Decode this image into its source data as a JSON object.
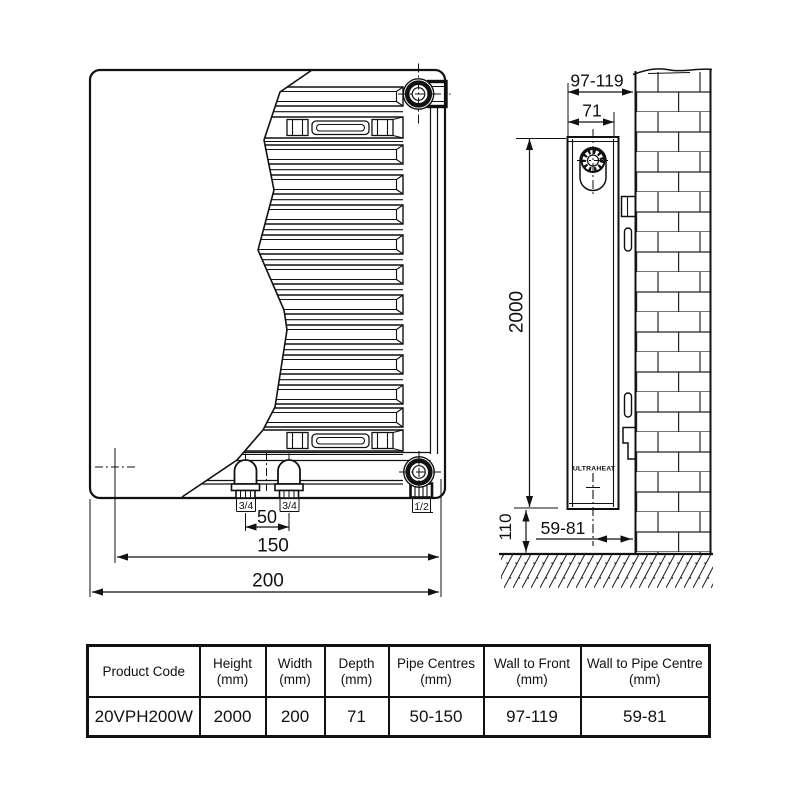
{
  "front_view": {
    "pipe_size_left": "3/4",
    "pipe_size_right": "3/4",
    "vent_size": "1/2",
    "pipe_centres": "50",
    "pipe_span_max": "150",
    "width": "200"
  },
  "side_view": {
    "wall_to_front": "97-119",
    "depth": "71",
    "height": "2000",
    "floor_clearance": "110",
    "wall_to_pipe_centre": "59-81",
    "brand": "ULTRAHEAT"
  },
  "table": {
    "headers": [
      {
        "label": "Product Code",
        "unit": ""
      },
      {
        "label": "Height",
        "unit": "(mm)"
      },
      {
        "label": "Width",
        "unit": "(mm)"
      },
      {
        "label": "Depth",
        "unit": "(mm)"
      },
      {
        "label": "Pipe Centres",
        "unit": "(mm)"
      },
      {
        "label": "Wall to Front",
        "unit": "(mm)"
      },
      {
        "label": "Wall to Pipe Centre",
        "unit": "(mm)"
      }
    ],
    "row": {
      "product_code": "20VPH200W",
      "height": "2000",
      "width": "200",
      "depth": "71",
      "pipe_centres": "50-150",
      "wall_to_front": "97-119",
      "wall_to_pipe_centre": "59-81"
    }
  },
  "colors": {
    "line": "#111111",
    "background": "#ffffff"
  }
}
